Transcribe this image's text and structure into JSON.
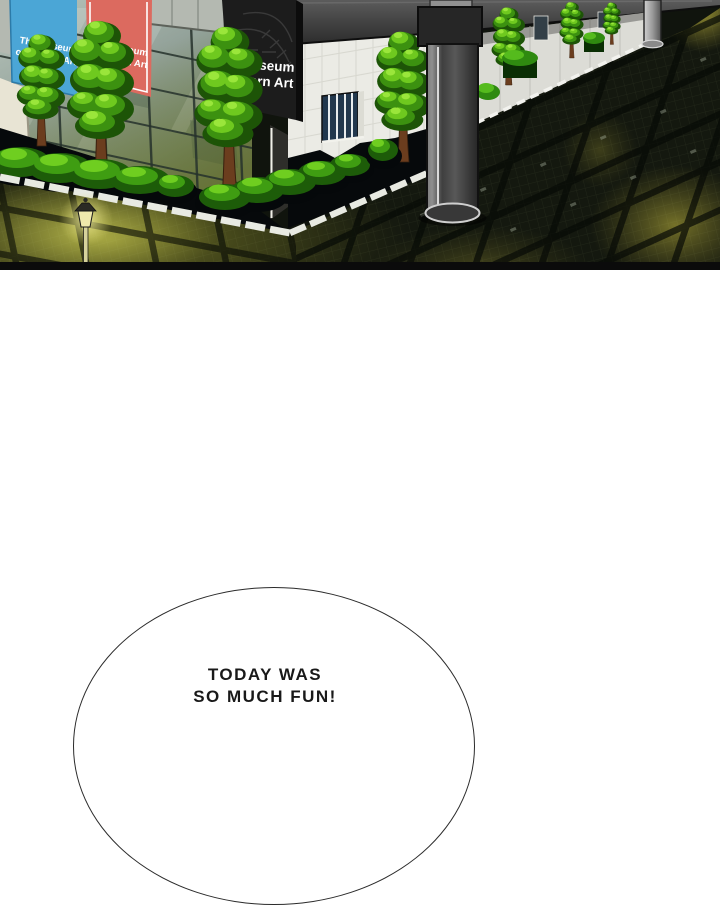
{
  "panel": {
    "banner_blue": {
      "line1": "The Museum",
      "line2": "of Modern Art"
    },
    "banner_red": {
      "line1": "The Museum",
      "line2": "of Modern Art"
    },
    "wall_sign": {
      "line1": "Museum",
      "line2": "ern Art"
    }
  },
  "speech_bubble": {
    "line1": "TODAY WAS",
    "line2": "SO MUCH FUN!"
  },
  "colors": {
    "banner_blue": "#4ba6d6",
    "banner_red": "#dc6a5f",
    "sign_bg": "#1c1c1c",
    "glass_mid": "#93a29a",
    "wall_white": "#ebebe5",
    "foliage_bright": "#6fc91f",
    "glow_yellow": "#b8b246",
    "ground_dark": "#14180f",
    "bubble_outline": "#2b2b2b"
  }
}
